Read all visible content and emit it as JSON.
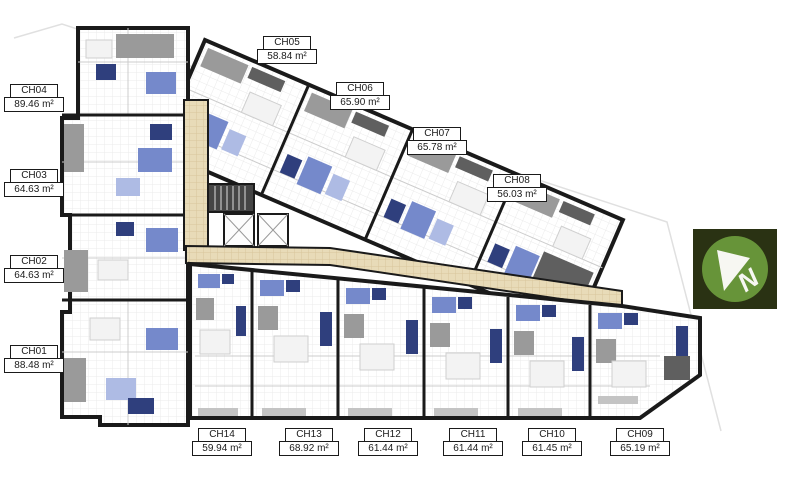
{
  "page": {
    "background": "#ffffff",
    "description": "Apartment building typical floor plan with unit labels"
  },
  "colors": {
    "wall": "#1a1a1a",
    "floor": "#ffffff",
    "floor_grid": "#ebebeb",
    "corridor": "#e8dbb8",
    "corridor_grid": "#d8c69b",
    "balcony_gray": "#9a9a9a",
    "dark_gray": "#5f5f5f",
    "light_gray": "#c4c4c4",
    "fixture_blue": "#7589cb",
    "fixture_blue_dark": "#2f3f7d",
    "fixture_blue_light": "#aebbe4",
    "boundary": "#e0e0e0",
    "label_border": "#1a1a1a",
    "label_bg": "#ffffff",
    "label_text": "#1a1a1a",
    "north_bg": "#2a3213",
    "north_circle": "#679439",
    "north_glyph": "#f7f7f2"
  },
  "units": [
    {
      "id": "CH01",
      "name": "CH01",
      "area": "88.48 m²",
      "label": {
        "x": 34,
        "y": 345
      }
    },
    {
      "id": "CH02",
      "name": "CH02",
      "area": "64.63 m²",
      "label": {
        "x": 34,
        "y": 255
      }
    },
    {
      "id": "CH03",
      "name": "CH03",
      "area": "64.63 m²",
      "label": {
        "x": 34,
        "y": 169
      }
    },
    {
      "id": "CH04",
      "name": "CH04",
      "area": "89.46 m²",
      "label": {
        "x": 34,
        "y": 84
      }
    },
    {
      "id": "CH05",
      "name": "CH05",
      "area": "58.84 m²",
      "label": {
        "x": 287,
        "y": 36
      }
    },
    {
      "id": "CH06",
      "name": "CH06",
      "area": "65.90 m²",
      "label": {
        "x": 360,
        "y": 82
      }
    },
    {
      "id": "CH07",
      "name": "CH07",
      "area": "65.78 m²",
      "label": {
        "x": 437,
        "y": 127
      }
    },
    {
      "id": "CH08",
      "name": "CH08",
      "area": "56.03 m²",
      "label": {
        "x": 517,
        "y": 174
      }
    },
    {
      "id": "CH09",
      "name": "CH09",
      "area": "65.19 m²",
      "label": {
        "x": 640,
        "y": 428
      }
    },
    {
      "id": "CH10",
      "name": "CH10",
      "area": "61.45 m²",
      "label": {
        "x": 552,
        "y": 428
      }
    },
    {
      "id": "CH11",
      "name": "CH11",
      "area": "61.44 m²",
      "label": {
        "x": 473,
        "y": 428
      }
    },
    {
      "id": "CH12",
      "name": "CH12",
      "area": "61.44 m²",
      "label": {
        "x": 388,
        "y": 428
      }
    },
    {
      "id": "CH13",
      "name": "CH13",
      "area": "68.92 m²",
      "label": {
        "x": 309,
        "y": 428
      }
    },
    {
      "id": "CH14",
      "name": "CH14",
      "area": "59.94 m²",
      "label": {
        "x": 222,
        "y": 428
      }
    }
  ],
  "north_badge": {
    "letter": "N"
  }
}
